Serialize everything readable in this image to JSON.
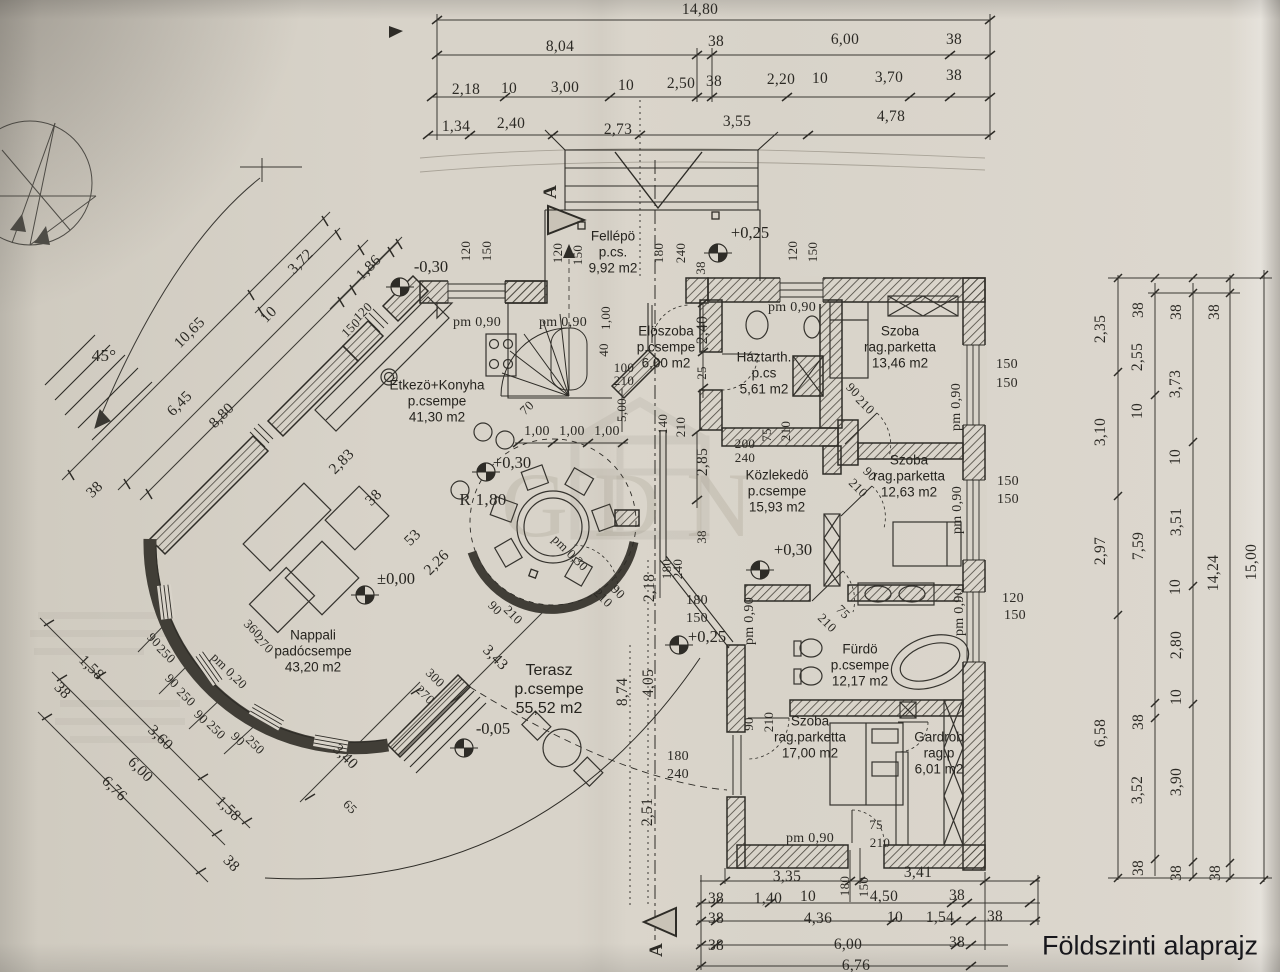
{
  "title": "Földszinti alaprajz",
  "section": {
    "letter": "A"
  },
  "watermark": "GDN",
  "colors": {
    "paper": "#d8d3c9",
    "ink": "#2e2c27"
  },
  "rooms": [
    {
      "lines": [
        "Fellépö",
        "p.cs.",
        "9,92 m2"
      ],
      "x": 613,
      "y": 253
    },
    {
      "lines": [
        "Elöszoba",
        "p.csempe",
        "6,00 m2"
      ],
      "x": 666,
      "y": 348
    },
    {
      "lines": [
        "Háztarth.",
        "p.cs",
        "5,61 m2"
      ],
      "x": 764,
      "y": 374
    },
    {
      "lines": [
        "Szoba",
        "rag.parketta",
        "13,46 m2"
      ],
      "x": 900,
      "y": 348
    },
    {
      "lines": [
        "Étkezö+Konyha",
        "p.csempe",
        "41,30 m2"
      ],
      "x": 437,
      "y": 402
    },
    {
      "lines": [
        "Közlekedö",
        "p.csempe",
        "15,93 m2"
      ],
      "x": 777,
      "y": 492
    },
    {
      "lines": [
        "Szoba",
        "rag.parketta",
        "12,63 m2"
      ],
      "x": 909,
      "y": 477
    },
    {
      "lines": [
        "Nappali",
        "padócsempe",
        "43,20 m2"
      ],
      "x": 313,
      "y": 652
    },
    {
      "lines": [
        "Terasz",
        "p.csempe",
        "55,52 m2"
      ],
      "x": 549,
      "y": 690,
      "big": true
    },
    {
      "lines": [
        "Fürdö",
        "p.csempe",
        "12,17 m2"
      ],
      "x": 860,
      "y": 666
    },
    {
      "lines": [
        "Szoba",
        "rag.parketta",
        "17,00 m2"
      ],
      "x": 810,
      "y": 738
    },
    {
      "lines": [
        "Gardrob",
        "rag.p",
        "6,01 m2"
      ],
      "x": 939,
      "y": 754
    }
  ],
  "levels": [
    {
      "t": "-0,30",
      "x": 431,
      "y": 267
    },
    {
      "t": "+0,25",
      "x": 750,
      "y": 233
    },
    {
      "t": "+0,30",
      "x": 512,
      "y": 463
    },
    {
      "t": "±0,00",
      "x": 396,
      "y": 579
    },
    {
      "t": "+0,30",
      "x": 793,
      "y": 550
    },
    {
      "t": "+0,25",
      "x": 707,
      "y": 637
    },
    {
      "t": "-0,05",
      "x": 493,
      "y": 729
    }
  ],
  "dimensions": [
    {
      "t": "14,80",
      "x": 700,
      "y": 10
    },
    {
      "t": "8,04",
      "x": 560,
      "y": 47
    },
    {
      "t": "38",
      "x": 716,
      "y": 42
    },
    {
      "t": "6,00",
      "x": 845,
      "y": 40
    },
    {
      "t": "38",
      "x": 954,
      "y": 40
    },
    {
      "t": "2,18",
      "x": 466,
      "y": 90
    },
    {
      "t": "10",
      "x": 509,
      "y": 89
    },
    {
      "t": "3,00",
      "x": 565,
      "y": 88
    },
    {
      "t": "10",
      "x": 626,
      "y": 86
    },
    {
      "t": "2,50",
      "x": 681,
      "y": 84
    },
    {
      "t": "38",
      "x": 714,
      "y": 82
    },
    {
      "t": "2,20",
      "x": 781,
      "y": 80
    },
    {
      "t": "10",
      "x": 820,
      "y": 79
    },
    {
      "t": "3,70",
      "x": 889,
      "y": 78
    },
    {
      "t": "38",
      "x": 954,
      "y": 76
    },
    {
      "t": "1,34",
      "x": 456,
      "y": 127
    },
    {
      "t": "2,40",
      "x": 511,
      "y": 124
    },
    {
      "t": "2,73",
      "x": 618,
      "y": 130
    },
    {
      "t": "3,55",
      "x": 737,
      "y": 122
    },
    {
      "t": "4,78",
      "x": 891,
      "y": 117
    },
    {
      "t": "2,35",
      "x": 1101,
      "y": 329,
      "r": -90
    },
    {
      "t": "3,10",
      "x": 1101,
      "y": 432,
      "r": -90
    },
    {
      "t": "2,97",
      "x": 1101,
      "y": 551,
      "r": -90
    },
    {
      "t": "6,58",
      "x": 1101,
      "y": 733,
      "r": -90
    },
    {
      "t": "38",
      "x": 1139,
      "y": 310,
      "r": -90
    },
    {
      "t": "2,55",
      "x": 1138,
      "y": 357,
      "r": -90
    },
    {
      "t": "10",
      "x": 1138,
      "y": 411,
      "r": -90
    },
    {
      "t": "7,59",
      "x": 1139,
      "y": 546,
      "r": -90
    },
    {
      "t": "38",
      "x": 1139,
      "y": 722,
      "r": -90
    },
    {
      "t": "3,52",
      "x": 1138,
      "y": 790,
      "r": -90
    },
    {
      "t": "38",
      "x": 1139,
      "y": 868,
      "r": -90
    },
    {
      "t": "38",
      "x": 1177,
      "y": 312,
      "r": -90
    },
    {
      "t": "3,73",
      "x": 1176,
      "y": 384,
      "r": -90
    },
    {
      "t": "10",
      "x": 1176,
      "y": 457,
      "r": -90
    },
    {
      "t": "3,51",
      "x": 1177,
      "y": 522,
      "r": -90
    },
    {
      "t": "10",
      "x": 1176,
      "y": 587,
      "r": -90
    },
    {
      "t": "2,80",
      "x": 1177,
      "y": 645,
      "r": -90
    },
    {
      "t": "10",
      "x": 1177,
      "y": 697,
      "r": -90
    },
    {
      "t": "3,90",
      "x": 1177,
      "y": 782,
      "r": -90
    },
    {
      "t": "38",
      "x": 1177,
      "y": 873,
      "r": -90
    },
    {
      "t": "38",
      "x": 1215,
      "y": 312,
      "r": -90
    },
    {
      "t": "14,24",
      "x": 1214,
      "y": 573,
      "r": -90
    },
    {
      "t": "38",
      "x": 1216,
      "y": 873,
      "r": -90
    },
    {
      "t": "15,00",
      "x": 1252,
      "y": 562,
      "r": -90
    },
    {
      "t": "3,35",
      "x": 787,
      "y": 877
    },
    {
      "t": "180",
      "x": 845,
      "y": 886,
      "r": -90,
      "s": 13
    },
    {
      "t": "150",
      "x": 864,
      "y": 887,
      "r": -90,
      "s": 13
    },
    {
      "t": "3,41",
      "x": 918,
      "y": 873
    },
    {
      "t": "38",
      "x": 716,
      "y": 899
    },
    {
      "t": "1,40",
      "x": 768,
      "y": 899
    },
    {
      "t": "10",
      "x": 808,
      "y": 897
    },
    {
      "t": "4,50",
      "x": 884,
      "y": 897
    },
    {
      "t": "38",
      "x": 957,
      "y": 896
    },
    {
      "t": "38",
      "x": 716,
      "y": 919
    },
    {
      "t": "4,36",
      "x": 818,
      "y": 919
    },
    {
      "t": "10",
      "x": 895,
      "y": 918
    },
    {
      "t": "1,54",
      "x": 940,
      "y": 918
    },
    {
      "t": "38",
      "x": 995,
      "y": 917
    },
    {
      "t": "38",
      "x": 716,
      "y": 946
    },
    {
      "t": "6,00",
      "x": 848,
      "y": 945
    },
    {
      "t": "38",
      "x": 957,
      "y": 943
    },
    {
      "t": "6,76",
      "x": 856,
      "y": 966
    },
    {
      "t": "3,72",
      "x": 301,
      "y": 262,
      "r": -45
    },
    {
      "t": "1,86",
      "x": 369,
      "y": 268,
      "r": -45
    },
    {
      "t": "120",
      "x": 363,
      "y": 312,
      "r": -45,
      "s": 13
    },
    {
      "t": "150",
      "x": 351,
      "y": 328,
      "r": -45,
      "s": 13
    },
    {
      "t": "45°",
      "x": 104,
      "y": 356,
      "s": 17
    },
    {
      "t": "10,65",
      "x": 190,
      "y": 333,
      "r": -45
    },
    {
      "t": "10",
      "x": 269,
      "y": 315,
      "r": -45
    },
    {
      "t": "6,45",
      "x": 180,
      "y": 404,
      "r": -45
    },
    {
      "t": "8,80",
      "x": 222,
      "y": 416,
      "r": -45
    },
    {
      "t": "38",
      "x": 95,
      "y": 490,
      "r": -45
    },
    {
      "t": "2,83",
      "x": 342,
      "y": 462,
      "r": -45
    },
    {
      "t": "38",
      "x": 374,
      "y": 498,
      "r": -45
    },
    {
      "t": "53",
      "x": 413,
      "y": 538,
      "r": -45
    },
    {
      "t": "2,26",
      "x": 437,
      "y": 563,
      "r": -45
    },
    {
      "t": "1,58",
      "x": 91,
      "y": 668,
      "r": 45
    },
    {
      "t": "38",
      "x": 62,
      "y": 691,
      "r": 45
    },
    {
      "t": "3,60",
      "x": 160,
      "y": 738,
      "r": 45
    },
    {
      "t": "6,00",
      "x": 140,
      "y": 770,
      "r": 45
    },
    {
      "t": "6,76",
      "x": 114,
      "y": 789,
      "r": 45
    },
    {
      "t": "1,58",
      "x": 228,
      "y": 809,
      "r": 45
    },
    {
      "t": "38",
      "x": 231,
      "y": 864,
      "r": 45
    },
    {
      "t": "90",
      "x": 154,
      "y": 640,
      "r": 45,
      "s": 13
    },
    {
      "t": "250",
      "x": 166,
      "y": 654,
      "r": 45,
      "s": 13
    },
    {
      "t": "90",
      "x": 172,
      "y": 681,
      "r": 45,
      "s": 13
    },
    {
      "t": "250",
      "x": 186,
      "y": 697,
      "r": 45,
      "s": 13
    },
    {
      "t": "90",
      "x": 201,
      "y": 717,
      "r": 45,
      "s": 13
    },
    {
      "t": "250",
      "x": 216,
      "y": 730,
      "r": 45,
      "s": 13
    },
    {
      "t": "90",
      "x": 238,
      "y": 739,
      "r": 45,
      "s": 13
    },
    {
      "t": "250",
      "x": 255,
      "y": 745,
      "r": 45,
      "s": 13
    },
    {
      "t": "pm 0,20",
      "x": 229,
      "y": 671,
      "r": 45,
      "s": 13
    },
    {
      "t": "360",
      "x": 253,
      "y": 629,
      "r": 45,
      "s": 13
    },
    {
      "t": "270",
      "x": 264,
      "y": 644,
      "r": 45,
      "s": 13
    },
    {
      "t": "300",
      "x": 435,
      "y": 678,
      "r": 45,
      "s": 13
    },
    {
      "t": "270",
      "x": 425,
      "y": 695,
      "r": 45,
      "s": 13
    },
    {
      "t": "3,40",
      "x": 345,
      "y": 757,
      "r": 45
    },
    {
      "t": "65",
      "x": 350,
      "y": 807,
      "r": 45,
      "s": 13
    },
    {
      "t": "3,43",
      "x": 495,
      "y": 658,
      "r": 45
    },
    {
      "t": "8,74",
      "x": 623,
      "y": 692,
      "r": -90
    },
    {
      "t": "4,05",
      "x": 649,
      "y": 683,
      "r": -90
    },
    {
      "t": "2,51",
      "x": 648,
      "y": 812,
      "r": -90
    },
    {
      "t": "120",
      "x": 466,
      "y": 251,
      "r": -90,
      "s": 13
    },
    {
      "t": "150",
      "x": 487,
      "y": 251,
      "r": -90,
      "s": 13
    },
    {
      "t": "120",
      "x": 558,
      "y": 253,
      "r": -90,
      "s": 13
    },
    {
      "t": "150",
      "x": 578,
      "y": 255,
      "r": -90,
      "s": 13
    },
    {
      "t": "180",
      "x": 659,
      "y": 253,
      "r": -90,
      "s": 13
    },
    {
      "t": "240",
      "x": 681,
      "y": 253,
      "r": -90,
      "s": 13
    },
    {
      "t": "38",
      "x": 701,
      "y": 268,
      "r": -90,
      "s": 13
    },
    {
      "t": "120",
      "x": 793,
      "y": 251,
      "r": -90,
      "s": 13
    },
    {
      "t": "150",
      "x": 813,
      "y": 252,
      "r": -90,
      "s": 13
    },
    {
      "t": "pm 0,90",
      "x": 792,
      "y": 308,
      "s": 14
    },
    {
      "t": "pm 0,90",
      "x": 477,
      "y": 323,
      "s": 14
    },
    {
      "t": "pm 0,90",
      "x": 563,
      "y": 323,
      "s": 14
    },
    {
      "t": "1,00",
      "x": 537,
      "y": 432,
      "s": 14
    },
    {
      "t": "1,00",
      "x": 572,
      "y": 432,
      "s": 14
    },
    {
      "t": "1,00",
      "x": 607,
      "y": 432,
      "s": 14
    },
    {
      "t": "70",
      "x": 527,
      "y": 408,
      "r": -45,
      "s": 13
    },
    {
      "t": "5,00",
      "x": 622,
      "y": 410,
      "r": -90,
      "s": 13
    },
    {
      "t": "1,00",
      "x": 606,
      "y": 318,
      "r": -90,
      "s": 13
    },
    {
      "t": "40",
      "x": 604,
      "y": 350,
      "r": -90,
      "s": 13
    },
    {
      "t": "100",
      "x": 624,
      "y": 368,
      "s": 13
    },
    {
      "t": "210",
      "x": 624,
      "y": 381,
      "s": 13
    },
    {
      "t": "2,40",
      "x": 703,
      "y": 330,
      "r": -90
    },
    {
      "t": "25",
      "x": 702,
      "y": 373,
      "r": -90,
      "s": 13
    },
    {
      "t": "140",
      "x": 663,
      "y": 424,
      "r": -90,
      "s": 13
    },
    {
      "t": "210",
      "x": 681,
      "y": 427,
      "r": -90,
      "s": 13
    },
    {
      "t": "2,85",
      "x": 703,
      "y": 462,
      "r": -90
    },
    {
      "t": "200",
      "x": 745,
      "y": 444,
      "s": 13
    },
    {
      "t": "240",
      "x": 745,
      "y": 458,
      "s": 13
    },
    {
      "t": "75",
      "x": 767,
      "y": 435,
      "r": -90,
      "s": 13
    },
    {
      "t": "210",
      "x": 786,
      "y": 431,
      "r": -90,
      "s": 13
    },
    {
      "t": "90",
      "x": 853,
      "y": 390,
      "r": 45,
      "s": 13
    },
    {
      "t": "210",
      "x": 865,
      "y": 405,
      "r": 45,
      "s": 13
    },
    {
      "t": "90",
      "x": 870,
      "y": 474,
      "r": 45,
      "s": 13
    },
    {
      "t": "210",
      "x": 858,
      "y": 488,
      "r": 45,
      "s": 13
    },
    {
      "t": "pm 0,90",
      "x": 957,
      "y": 407,
      "r": -90,
      "s": 14
    },
    {
      "t": "150",
      "x": 1007,
      "y": 365,
      "s": 14
    },
    {
      "t": "150",
      "x": 1007,
      "y": 384,
      "s": 14
    },
    {
      "t": "pm 0,90",
      "x": 958,
      "y": 510,
      "r": -90,
      "s": 14
    },
    {
      "t": "150",
      "x": 1008,
      "y": 482,
      "s": 14
    },
    {
      "t": "150",
      "x": 1008,
      "y": 500,
      "s": 14
    },
    {
      "t": "38",
      "x": 702,
      "y": 537,
      "r": -90,
      "s": 13
    },
    {
      "t": "180",
      "x": 667,
      "y": 569,
      "r": -90,
      "s": 13
    },
    {
      "t": "240",
      "x": 678,
      "y": 569,
      "r": -90,
      "s": 13
    },
    {
      "t": "2,18",
      "x": 650,
      "y": 588,
      "r": -90
    },
    {
      "t": "180",
      "x": 697,
      "y": 601,
      "s": 14
    },
    {
      "t": "150",
      "x": 697,
      "y": 619,
      "s": 14
    },
    {
      "t": "pm 0,90",
      "x": 750,
      "y": 621,
      "r": -90,
      "s": 14
    },
    {
      "t": "75",
      "x": 843,
      "y": 612,
      "r": 45,
      "s": 13
    },
    {
      "t": "210",
      "x": 827,
      "y": 623,
      "r": 45,
      "s": 13
    },
    {
      "t": "90",
      "x": 749,
      "y": 724,
      "r": -90,
      "s": 13
    },
    {
      "t": "210",
      "x": 769,
      "y": 722,
      "r": -90,
      "s": 13
    },
    {
      "t": "pm 0,90",
      "x": 960,
      "y": 612,
      "r": -90,
      "s": 14
    },
    {
      "t": "120",
      "x": 1013,
      "y": 599,
      "s": 14
    },
    {
      "t": "150",
      "x": 1015,
      "y": 616,
      "s": 14
    },
    {
      "t": "180",
      "x": 678,
      "y": 757,
      "s": 14
    },
    {
      "t": "240",
      "x": 678,
      "y": 775,
      "s": 14
    },
    {
      "t": "75",
      "x": 876,
      "y": 825,
      "s": 13
    },
    {
      "t": "210",
      "x": 880,
      "y": 843,
      "s": 13
    },
    {
      "t": "pm 0,90",
      "x": 810,
      "y": 839,
      "s": 14
    },
    {
      "t": "R 1,80",
      "x": 483,
      "y": 500,
      "s": 17
    },
    {
      "t": "pm 0,30",
      "x": 570,
      "y": 553,
      "r": 45,
      "s": 13
    },
    {
      "t": "90",
      "x": 495,
      "y": 608,
      "r": 45,
      "s": 13
    },
    {
      "t": "210",
      "x": 513,
      "y": 615,
      "r": 45,
      "s": 13
    },
    {
      "t": "210",
      "x": 603,
      "y": 598,
      "r": 45,
      "s": 13
    },
    {
      "t": "90",
      "x": 618,
      "y": 592,
      "r": 45,
      "s": 13
    }
  ]
}
